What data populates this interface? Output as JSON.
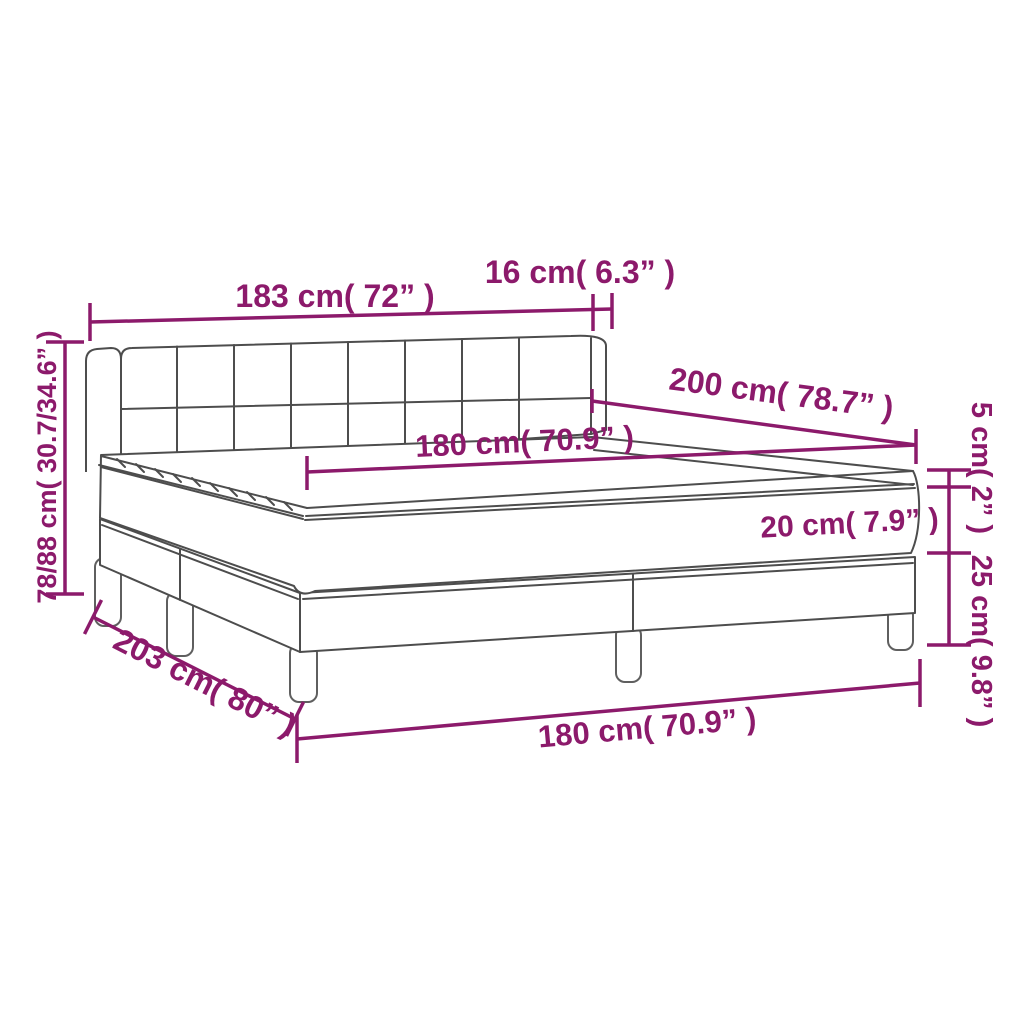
{
  "diagram": {
    "type": "product-dimension-diagram",
    "product": "box-spring-bed-with-mattress",
    "background_color": "#ffffff",
    "accent_color": "#8c1a6b",
    "line_color": "#4d4d4d",
    "labels": {
      "headboard_width": "183 cm( 72” )",
      "side_offset": "16 cm( 6.3” )",
      "length": "200 cm( 78.7” )",
      "mattress_width": "180 cm( 70.9” )",
      "height_range": "78/88 cm( 30.7/34.6” )",
      "topper_thickness": "5 cm( 2” )",
      "mattress_thickness": "20 cm( 7.9” )",
      "base_height": "25 cm( 9.8” )",
      "diagonal_depth": "203 cm( 80” )",
      "base_width": "180 cm( 70.9” )"
    }
  }
}
